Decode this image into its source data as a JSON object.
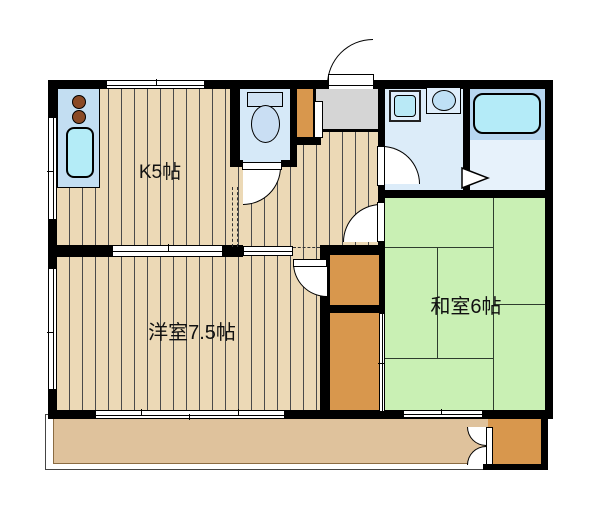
{
  "plan": {
    "rooms": [
      {
        "id": "kitchen",
        "label": "K5帖"
      },
      {
        "id": "western-room",
        "label": "洋室7.5帖"
      },
      {
        "id": "japanese-room",
        "label": "和室6帖"
      }
    ],
    "fixtures": [
      "stove-burners",
      "kitchen-sink",
      "toilet",
      "washing-machine-pan",
      "vanity-sink",
      "bathtub",
      "shoe-cabinet",
      "entry-genkan",
      "closets",
      "balcony-storage",
      "balcony"
    ],
    "colors": {
      "wall": "#000000",
      "wood_floor": "#ecd9b6",
      "plank_line": "#4a4a4a",
      "tatami_green": "#c9f0b4",
      "closet_orange": "#d8974d",
      "genkan_gray": "#d5d5d5",
      "balcony_tan": "#dfc29c",
      "wet_room_blue": "#dcecf9",
      "bath_blue": "#b7d6f0",
      "fixture_cyan": "#b4ecf7"
    }
  }
}
